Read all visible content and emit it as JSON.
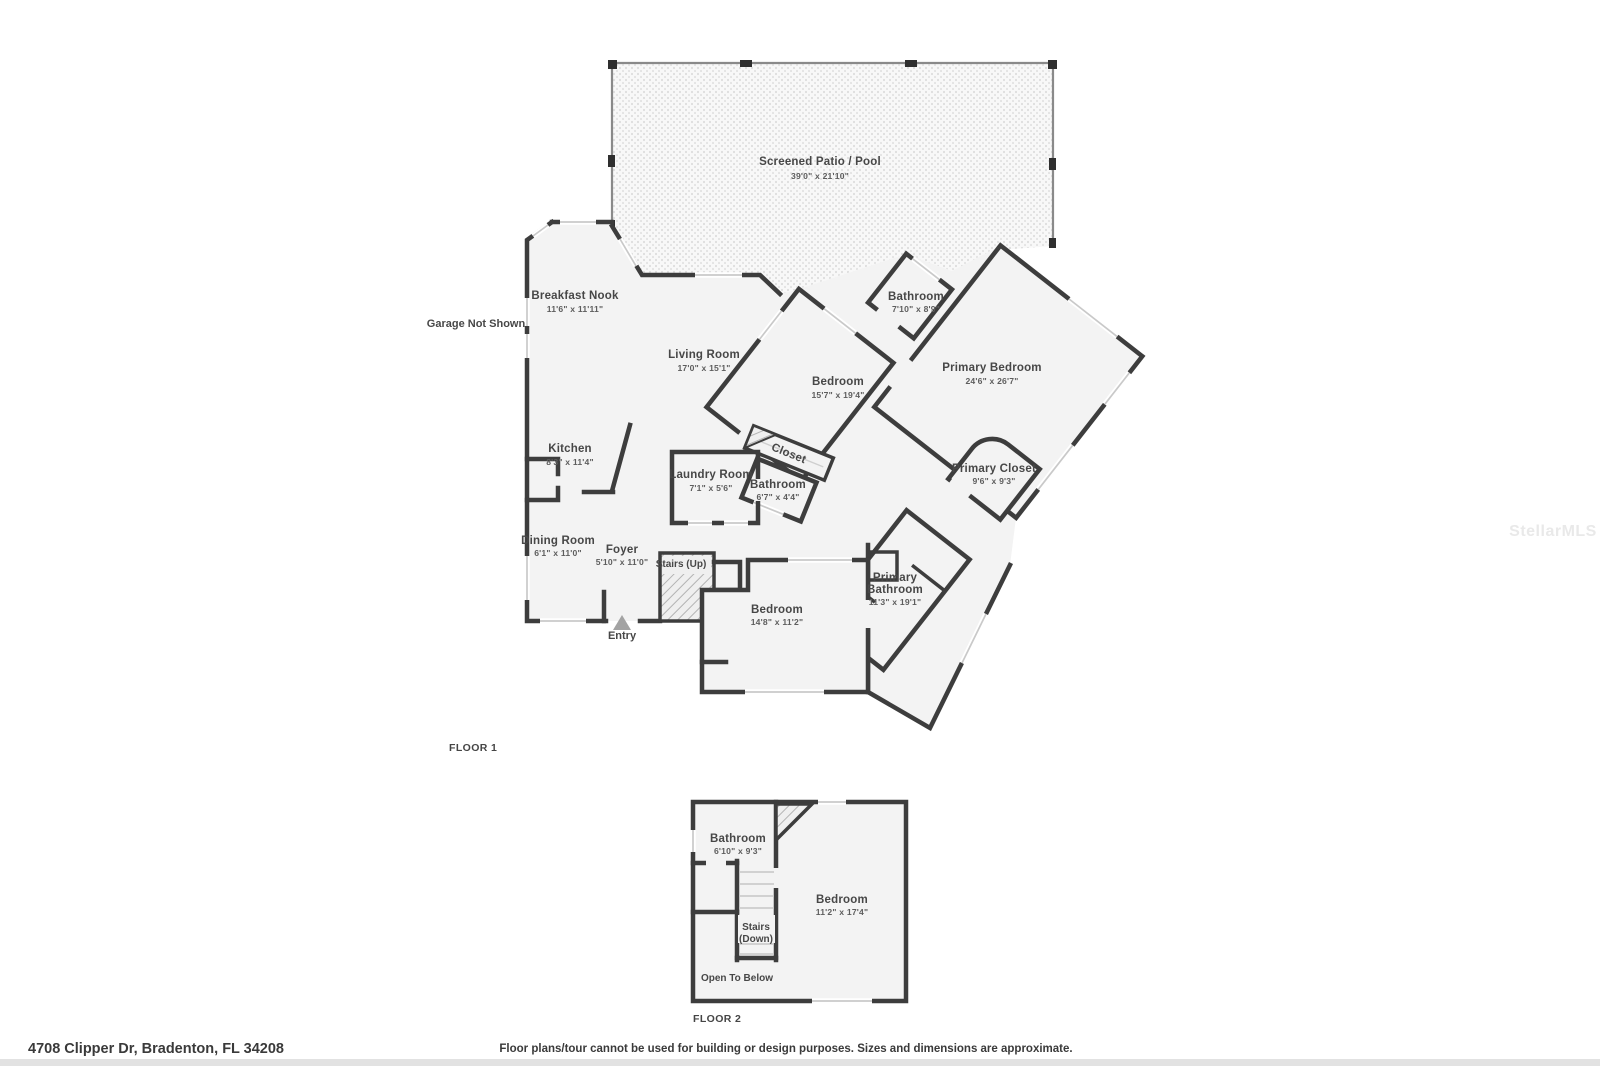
{
  "watermark": "StellarMLS",
  "address": "4708 Clipper Dr, Bradenton, FL 34208",
  "disclaimer": "Floor plans/tour cannot be used for building or design purposes. Sizes and dimensions are approximate.",
  "colors": {
    "wall": "#3d3d3d",
    "room_fill": "#f3f3f3",
    "text": "#474747"
  },
  "floor1": {
    "label": "FLOOR 1",
    "annotations": {
      "garage": "Garage Not Shown",
      "entry": "Entry"
    },
    "rooms": [
      {
        "name": "Screened Patio / Pool",
        "dims": "39'0\" x 21'10\""
      },
      {
        "name": "Breakfast Nook",
        "dims": "11'6\" x 11'11\""
      },
      {
        "name": "Living Room",
        "dims": "17'0\" x 15'1\""
      },
      {
        "name": "Kitchen",
        "dims": "8'3\" x 11'4\""
      },
      {
        "name": "Laundry Room",
        "dims": "7'1\" x 5'6\""
      },
      {
        "name": "Bathroom",
        "dims": "6'7\" x 4'4\""
      },
      {
        "name": "Closet",
        "dims": ""
      },
      {
        "name": "Bedroom",
        "dims": "15'7\" x 19'4\""
      },
      {
        "name": "Bathroom",
        "dims": "7'10\" x 8'9\""
      },
      {
        "name": "Primary Bedroom",
        "dims": "24'6\" x 26'7\""
      },
      {
        "name": "Primary Closet",
        "dims": "9'6\" x 9'3\""
      },
      {
        "name": "Dining Room",
        "dims": "6'1\" x 11'0\""
      },
      {
        "name": "Foyer",
        "dims": "5'10\" x 11'0\""
      },
      {
        "name": "Stairs (Up)",
        "dims": ""
      },
      {
        "name": "Bedroom",
        "dims": "14'8\" x 11'2\""
      },
      {
        "name": "Primary",
        "name2": "Bathroom",
        "dims": "11'3\" x 19'1\""
      }
    ]
  },
  "floor2": {
    "label": "FLOOR 2",
    "rooms": [
      {
        "name": "Bathroom",
        "dims": "6'10\" x 9'3\""
      },
      {
        "name": "Stairs",
        "name2": "(Down)",
        "dims": ""
      },
      {
        "name": "Open To Below",
        "dims": ""
      },
      {
        "name": "Bedroom",
        "dims": "11'2\" x 17'4\""
      }
    ]
  }
}
